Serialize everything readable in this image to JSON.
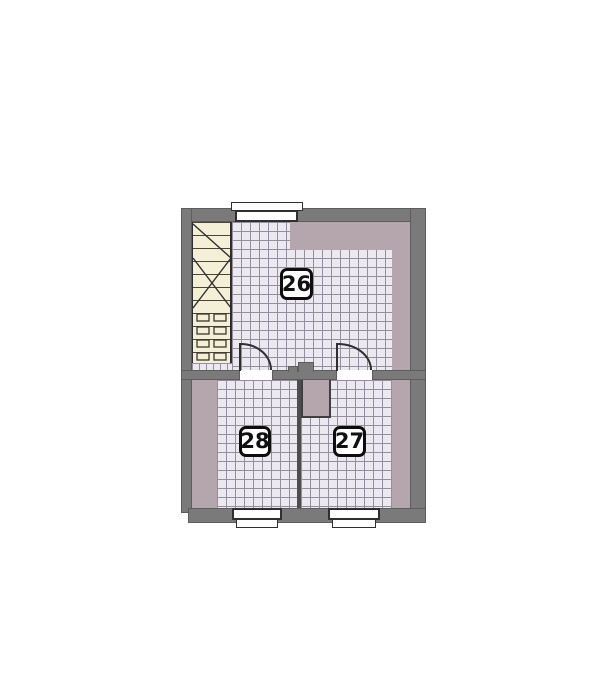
{
  "plan": {
    "type": "floor-plan",
    "rooms": [
      {
        "number": "26"
      },
      {
        "number": "27"
      },
      {
        "number": "28"
      }
    ],
    "features": {
      "staircase": "stair-flight-with-break-line",
      "doors": 2,
      "windows": 3,
      "chimney_block": 1
    },
    "colors": {
      "wall_gray": "#7a7a7a",
      "interior_wall_dark": "#4d4d4d",
      "tile_fill": "#ece8f0",
      "tile_grid_line": "#958e9e",
      "reduced_headroom_mauve": "#b4a6ac",
      "stair_cream": "#f6efd8",
      "outline_dark": "#2f2f2f",
      "window_white": "#ffffff"
    }
  }
}
